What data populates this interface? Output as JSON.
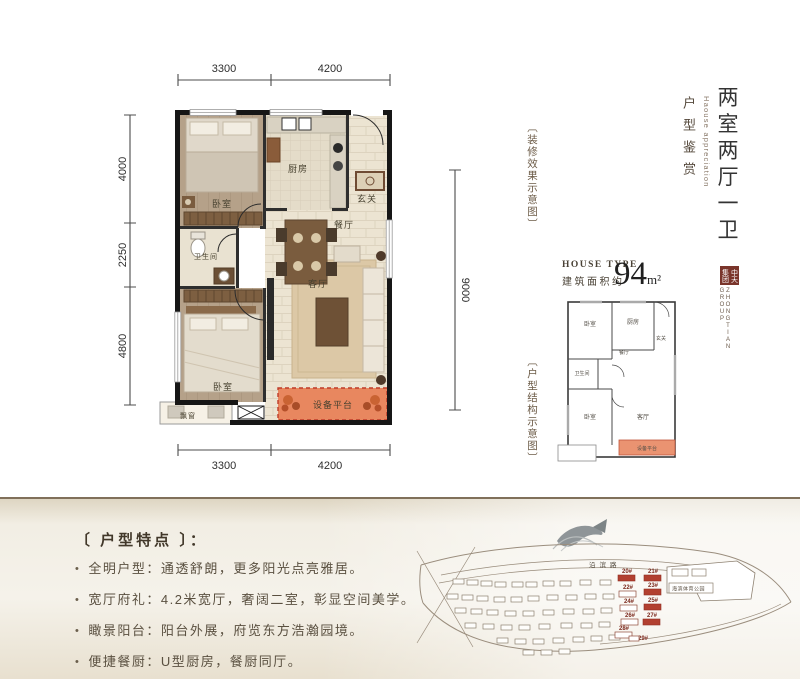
{
  "dims": {
    "top": [
      "3300",
      "4200"
    ],
    "left": [
      "4000",
      "2250",
      "4800"
    ],
    "right": "9000",
    "bottom": [
      "3300",
      "4200"
    ]
  },
  "plan": {
    "rooms": {
      "bedroom_a": "卧室",
      "kitchen": "厨房",
      "entry": "玄关",
      "dining": "餐厅",
      "bath": "卫生间",
      "living": "客厅",
      "bedroom_b": "卧室",
      "bay": "飘窗",
      "platform": "设备平台"
    }
  },
  "captions": {
    "deco": "〔装修效果示意图〕",
    "structure": "〔户型结构示意图〕"
  },
  "title": {
    "main": "两室两厅一卫",
    "en": "Haouse appreciation",
    "sub": "户型鉴赏"
  },
  "house_type": {
    "en": "HOUSE TYPE",
    "cn": "建筑面积约",
    "area": "94",
    "unit": "m²"
  },
  "brand": {
    "seal_right": "中天",
    "seal_left": "集团",
    "en_line1": "ZHONGTIAN",
    "en_line2": "GROUP"
  },
  "features": {
    "title": "〔 户型特点 〕：",
    "bullet": "•",
    "items": [
      "全明户型：通透舒朗，更多阳光点亮雅居。",
      "宽厅府礼：4.2米宽厅，奢阔二室，彰显空间美学。",
      "瞰景阳台：阳台外展，府览东方浩瀚园境。",
      "便捷餐厨：U型厨房，餐厨同厅。"
    ]
  },
  "map": {
    "road": "沿滨路",
    "park": "海滨体育公园",
    "buildings": [
      {
        "label": "20#",
        "highlight": true
      },
      {
        "label": "21#",
        "highlight": true
      },
      {
        "label": "22#",
        "highlight": false
      },
      {
        "label": "23#",
        "highlight": true
      },
      {
        "label": "24#",
        "highlight": false
      },
      {
        "label": "25#",
        "highlight": true
      },
      {
        "label": "26#",
        "highlight": false
      },
      {
        "label": "27#",
        "highlight": true
      },
      {
        "label": "28#",
        "highlight": false
      },
      {
        "label": "29#",
        "highlight": false
      }
    ]
  },
  "colors": {
    "platform_accent": "#e8875f",
    "brand_seal": "#7a352b",
    "building_highlight": "#b24030"
  }
}
